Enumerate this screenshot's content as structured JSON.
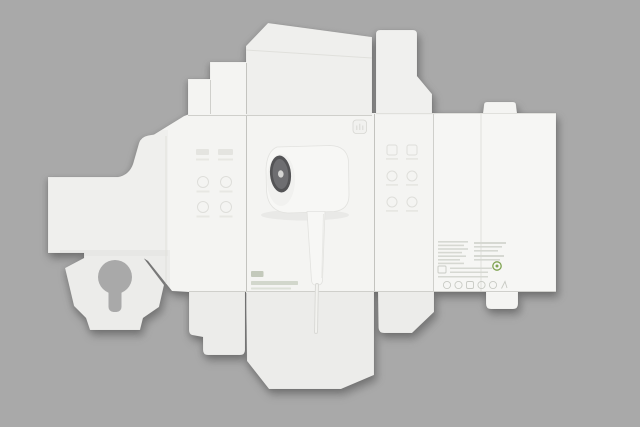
{
  "image": {
    "width": 640,
    "height": 427,
    "subject": "Unfolded white hair-dryer packaging box (die-cut flat) photographed on a gray background"
  },
  "colors": {
    "background": "#a9a9a9",
    "board": "#f4f4f2",
    "dryer_body": "#f7f7f5",
    "intake_dark": "#545456",
    "intake_mid": "#6e6e71",
    "intake_dot": "#d5d5d3",
    "cord": "#f2f2ef",
    "cord_edge": "#dadad7",
    "print_green": "#c3c9bb",
    "print_green_text": "#c9cfc2",
    "eco_green": "#7fa351"
  },
  "front_panel": {
    "logo_icon": "mijia-logo",
    "graphic": "hair-dryer",
    "brand_chip": "mijia-wordmark-chip",
    "brand_text_lines": 2
  },
  "left_panel": {
    "feature_icons": 6,
    "icon_layout": "2x3 grid with caption bars"
  },
  "right_panel": {
    "feature_icons": 6,
    "icon_layout": "2x3 grid with caption bars"
  },
  "spec_panel": {
    "spec_text_lines": 7,
    "info_text_lines": 5,
    "paragraph_blocks": 2,
    "eco_mark": "green-circular-logo",
    "certification_marks": 6
  },
  "cutouts": {
    "keyhole_hanger": 1
  }
}
